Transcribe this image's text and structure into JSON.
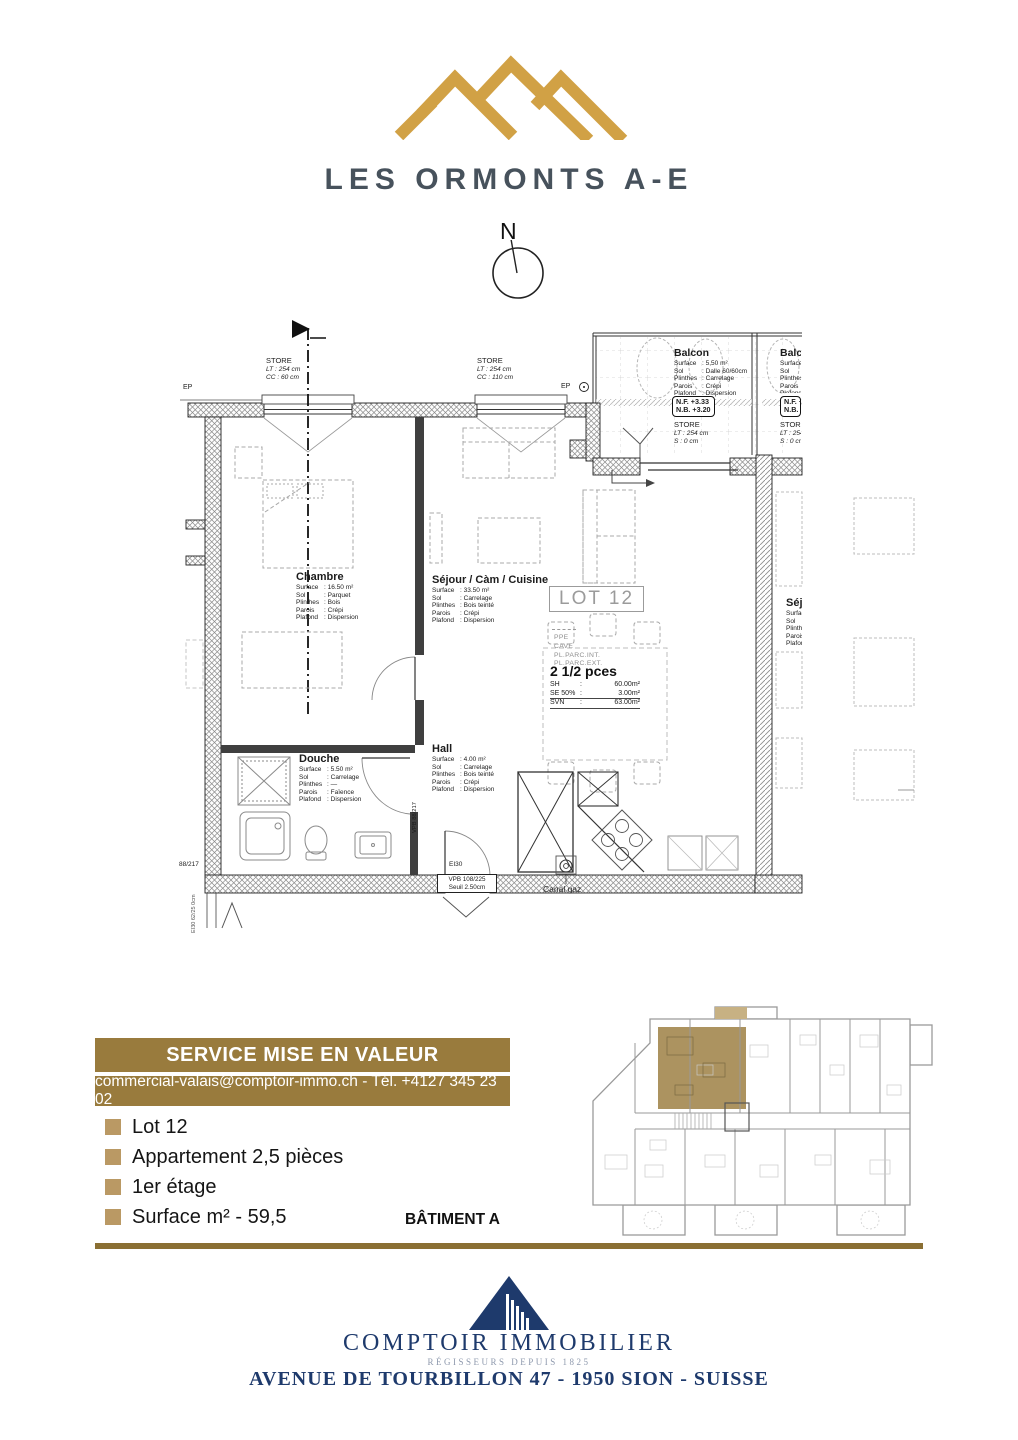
{
  "colors": {
    "gold": "#D1A145",
    "banner": "#997B3D",
    "divider": "#8A6F33",
    "bullet": "#BA9964",
    "navy": "#1E3A6C",
    "tagline_blue": "#8E99AD",
    "highlight": "#A88D57",
    "highlight_light": "#C7B183",
    "title_slate": "#47525C"
  },
  "header": {
    "title": "LES ORMONTS A-E"
  },
  "compass": {
    "n": "N"
  },
  "plan": {
    "ep": "EP",
    "stores": [
      {
        "title": "STORE",
        "l1": "LT : 254 cm",
        "l2": "CC : 60 cm"
      },
      {
        "title": "STORE",
        "l1": "LT : 254 cm",
        "l2": "CC : 110 cm"
      },
      {
        "title": "STORE",
        "l1": "LT : 254 cm",
        "l2": "S : 0 cm"
      }
    ],
    "nf": {
      "l1": "N.F. +3.33",
      "l2": "N.B. +3.20"
    },
    "balcon": {
      "name": "Balcon",
      "rows": [
        {
          "k": "Surface",
          "v": "5,50 m²"
        },
        {
          "k": "Sol",
          "v": "Dalle 60/60cm"
        },
        {
          "k": "Plinthes",
          "v": "Carrelage"
        },
        {
          "k": "Parois",
          "v": "Crépi"
        },
        {
          "k": "Plafond",
          "v": "Dispersion"
        }
      ]
    },
    "rooms": {
      "chambre": {
        "name": "Chambre",
        "rows": [
          {
            "k": "Surface",
            "v": "16.50 m²"
          },
          {
            "k": "Sol",
            "v": "Parquet"
          },
          {
            "k": "Plinthes",
            "v": "Bois"
          },
          {
            "k": "Parois",
            "v": "Crépi"
          },
          {
            "k": "Plafond",
            "v": "Dispersion"
          }
        ]
      },
      "sejour": {
        "name": "Séjour / Càm / Cuisine",
        "rows": [
          {
            "k": "Surface",
            "v": "33.50 m²"
          },
          {
            "k": "Sol",
            "v": "Carrelage"
          },
          {
            "k": "Plinthes",
            "v": "Bois teinté"
          },
          {
            "k": "Parois",
            "v": "Crépi"
          },
          {
            "k": "Plafond",
            "v": "Dispersion"
          }
        ]
      },
      "douche": {
        "name": "Douche",
        "rows": [
          {
            "k": "Surface",
            "v": "5.50 m²"
          },
          {
            "k": "Sol",
            "v": "Carrelage"
          },
          {
            "k": "Plinthes",
            "v": "—"
          },
          {
            "k": "Parois",
            "v": "Faïence"
          },
          {
            "k": "Plafond",
            "v": "Dispersion"
          }
        ]
      },
      "hall": {
        "name": "Hall",
        "rows": [
          {
            "k": "Surface",
            "v": "4.00 m²"
          },
          {
            "k": "Sol",
            "v": "Carrelage"
          },
          {
            "k": "Plinthes",
            "v": "Bois teinté"
          },
          {
            "k": "Parois",
            "v": "Crépi"
          },
          {
            "k": "Plafond",
            "v": "Dispersion"
          }
        ]
      }
    },
    "lot_label": "LOT 12",
    "ppe": [
      "PPE",
      "CAVE",
      "PL.PARC.INT.",
      "PL.PARC.EXT."
    ],
    "pces": {
      "title": "2 1/2 pces",
      "rows": [
        {
          "k": "SH",
          "v": "60.00m²"
        },
        {
          "k": "SE 50%",
          "v": "3.00m²"
        },
        {
          "k": "SVN",
          "v": "63.00m²"
        }
      ]
    },
    "ann": {
      "vpb_wall": "VPB 88/217",
      "cut_left": "88/217",
      "left_vert": "EI30 62/25 0cm",
      "ei30": "EI30",
      "door_l1": "VPB 108/225",
      "door_l2": "Seuil 2.50cm",
      "canal": "Canal gaz"
    }
  },
  "banner": {
    "title": "SERVICE MISE EN VALEUR",
    "contact": "commercial-valais@comptoir-immo.ch - Tél. +4127 345 23 02"
  },
  "details": {
    "items": [
      "Lot 12",
      "Appartement 2,5 pièces",
      "1er étage",
      "Surface m² - 59,5"
    ],
    "batiment": "BÂTIMENT A"
  },
  "footer": {
    "company": "COMPTOIR IMMOBILIER",
    "tagline": "RÉGISSEURS DEPUIS 1825",
    "address": "AVENUE DE TOURBILLON 47 - 1950 SION - SUISSE"
  }
}
